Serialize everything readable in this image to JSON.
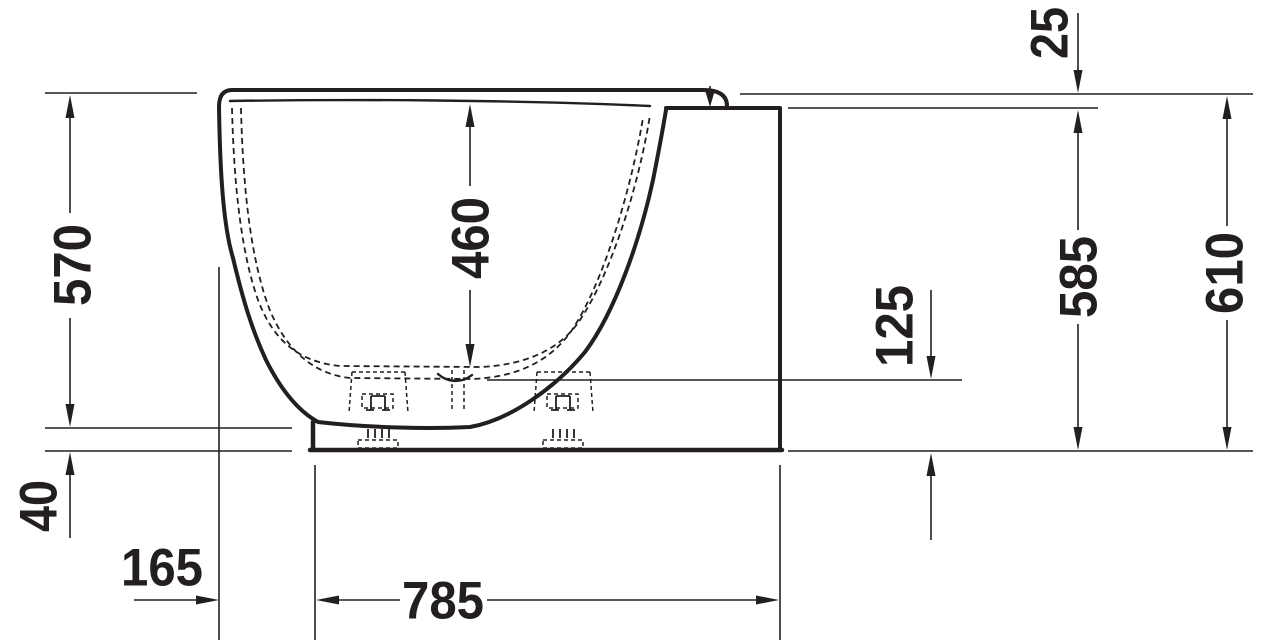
{
  "drawing": {
    "subject": "bathtub-side-elevation-technical-drawing",
    "line_color": "#231f20",
    "background_color": "#ffffff",
    "labels": {
      "height_rim": "570",
      "base_height": "40",
      "rim_setback": "165",
      "base_length": "785",
      "inner_depth": "460",
      "outlet_height": "125",
      "rim_overhang": "25",
      "panel_height": "585",
      "overall_height": "610"
    }
  }
}
